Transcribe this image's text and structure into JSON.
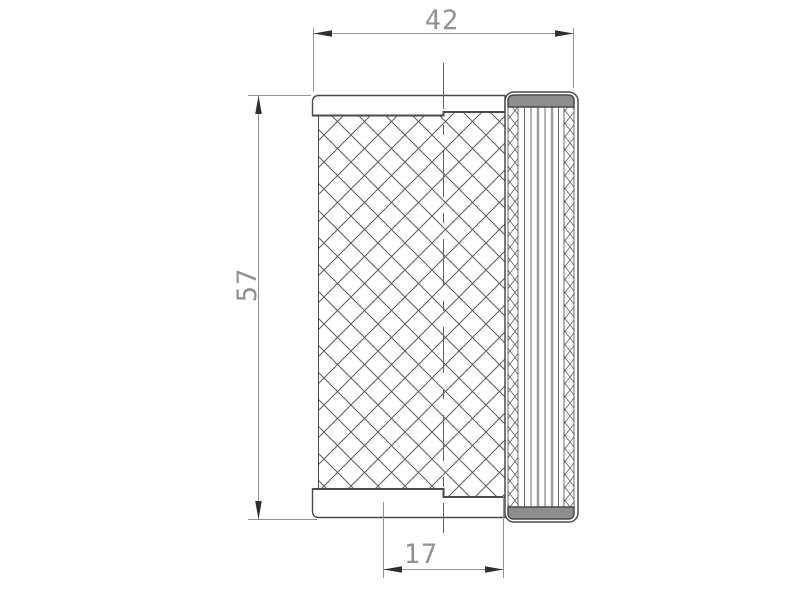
{
  "drawing": {
    "dimensions": {
      "width": "42",
      "height": "57",
      "inner_width": "17"
    },
    "colors": {
      "background": "#ffffff",
      "outline": "#4a4a4a",
      "hatch_line": "#5a5a5a",
      "dimension_line": "#919191",
      "arrow_fill": "#2f2f2f",
      "gasket_fill": "#8e8e8e"
    }
  }
}
